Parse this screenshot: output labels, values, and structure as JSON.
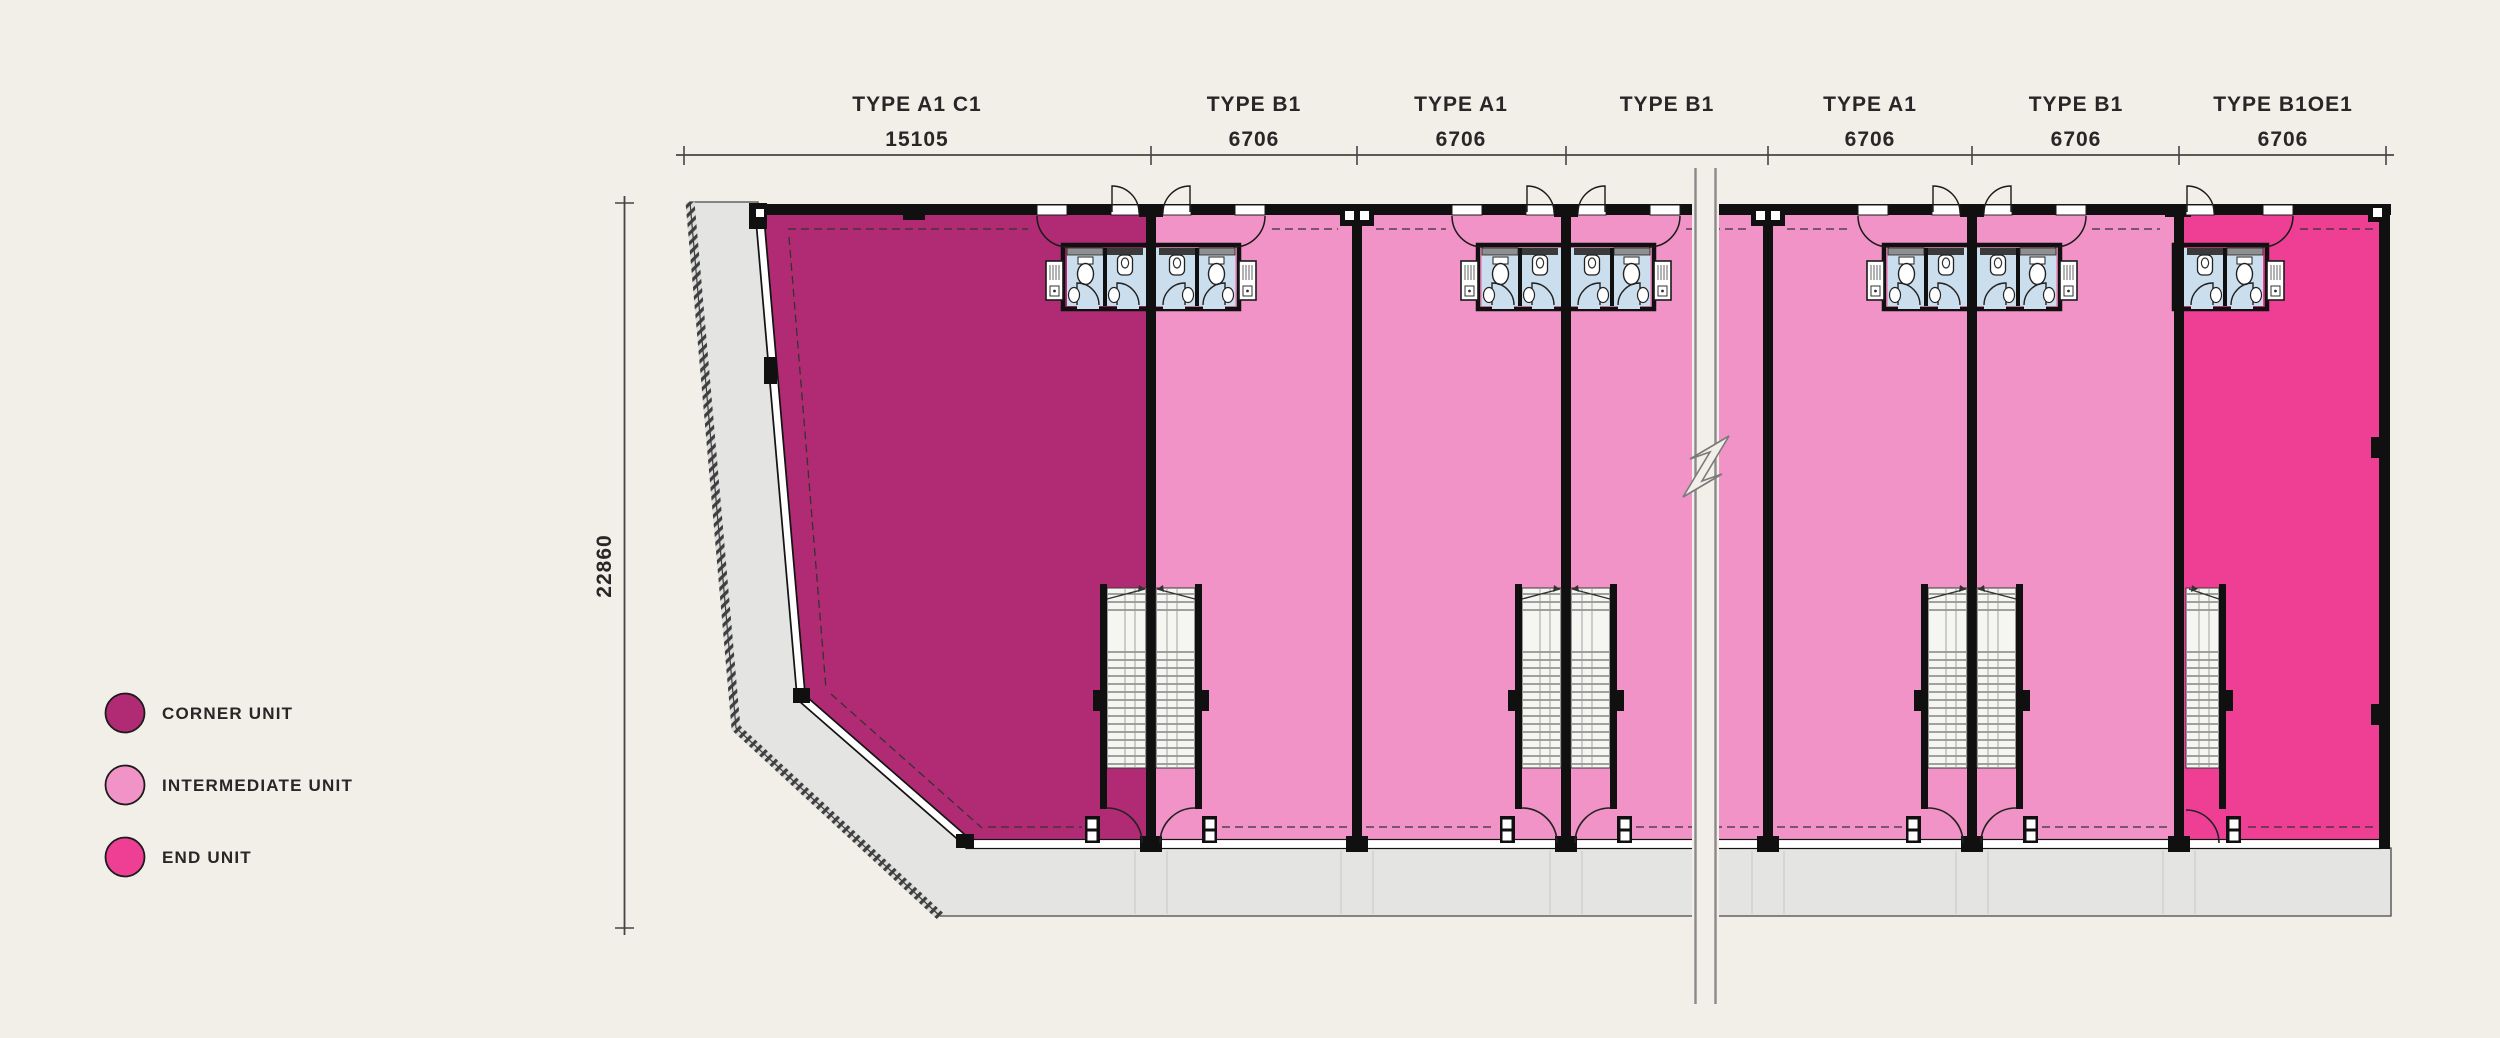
{
  "plan": {
    "segments": [
      {
        "name": "TYPE A1 C1",
        "dim": "15105"
      },
      {
        "name": "TYPE B1",
        "dim": "6706"
      },
      {
        "name": "TYPE A1",
        "dim": "6706"
      },
      {
        "name": "TYPE B1",
        "dim": ""
      },
      {
        "name": "TYPE A1",
        "dim": "6706"
      },
      {
        "name": "TYPE B1",
        "dim": "6706"
      },
      {
        "name": "TYPE B1OE1",
        "dim": "6706"
      }
    ],
    "vertical_dim": "22860",
    "colors": {
      "background": "#f2eee8",
      "corner": "#b12b74",
      "intermediate": "#f193c6",
      "end": "#ee3f95",
      "bathroom": "#cbdeee",
      "site": "#e4e4e2",
      "wall": "#101010"
    }
  },
  "legend": {
    "items": [
      {
        "label": "CORNER UNIT",
        "color": "#b12b74"
      },
      {
        "label": "INTERMEDIATE UNIT",
        "color": "#f193c6"
      },
      {
        "label": "END UNIT",
        "color": "#ee3f95"
      }
    ]
  }
}
